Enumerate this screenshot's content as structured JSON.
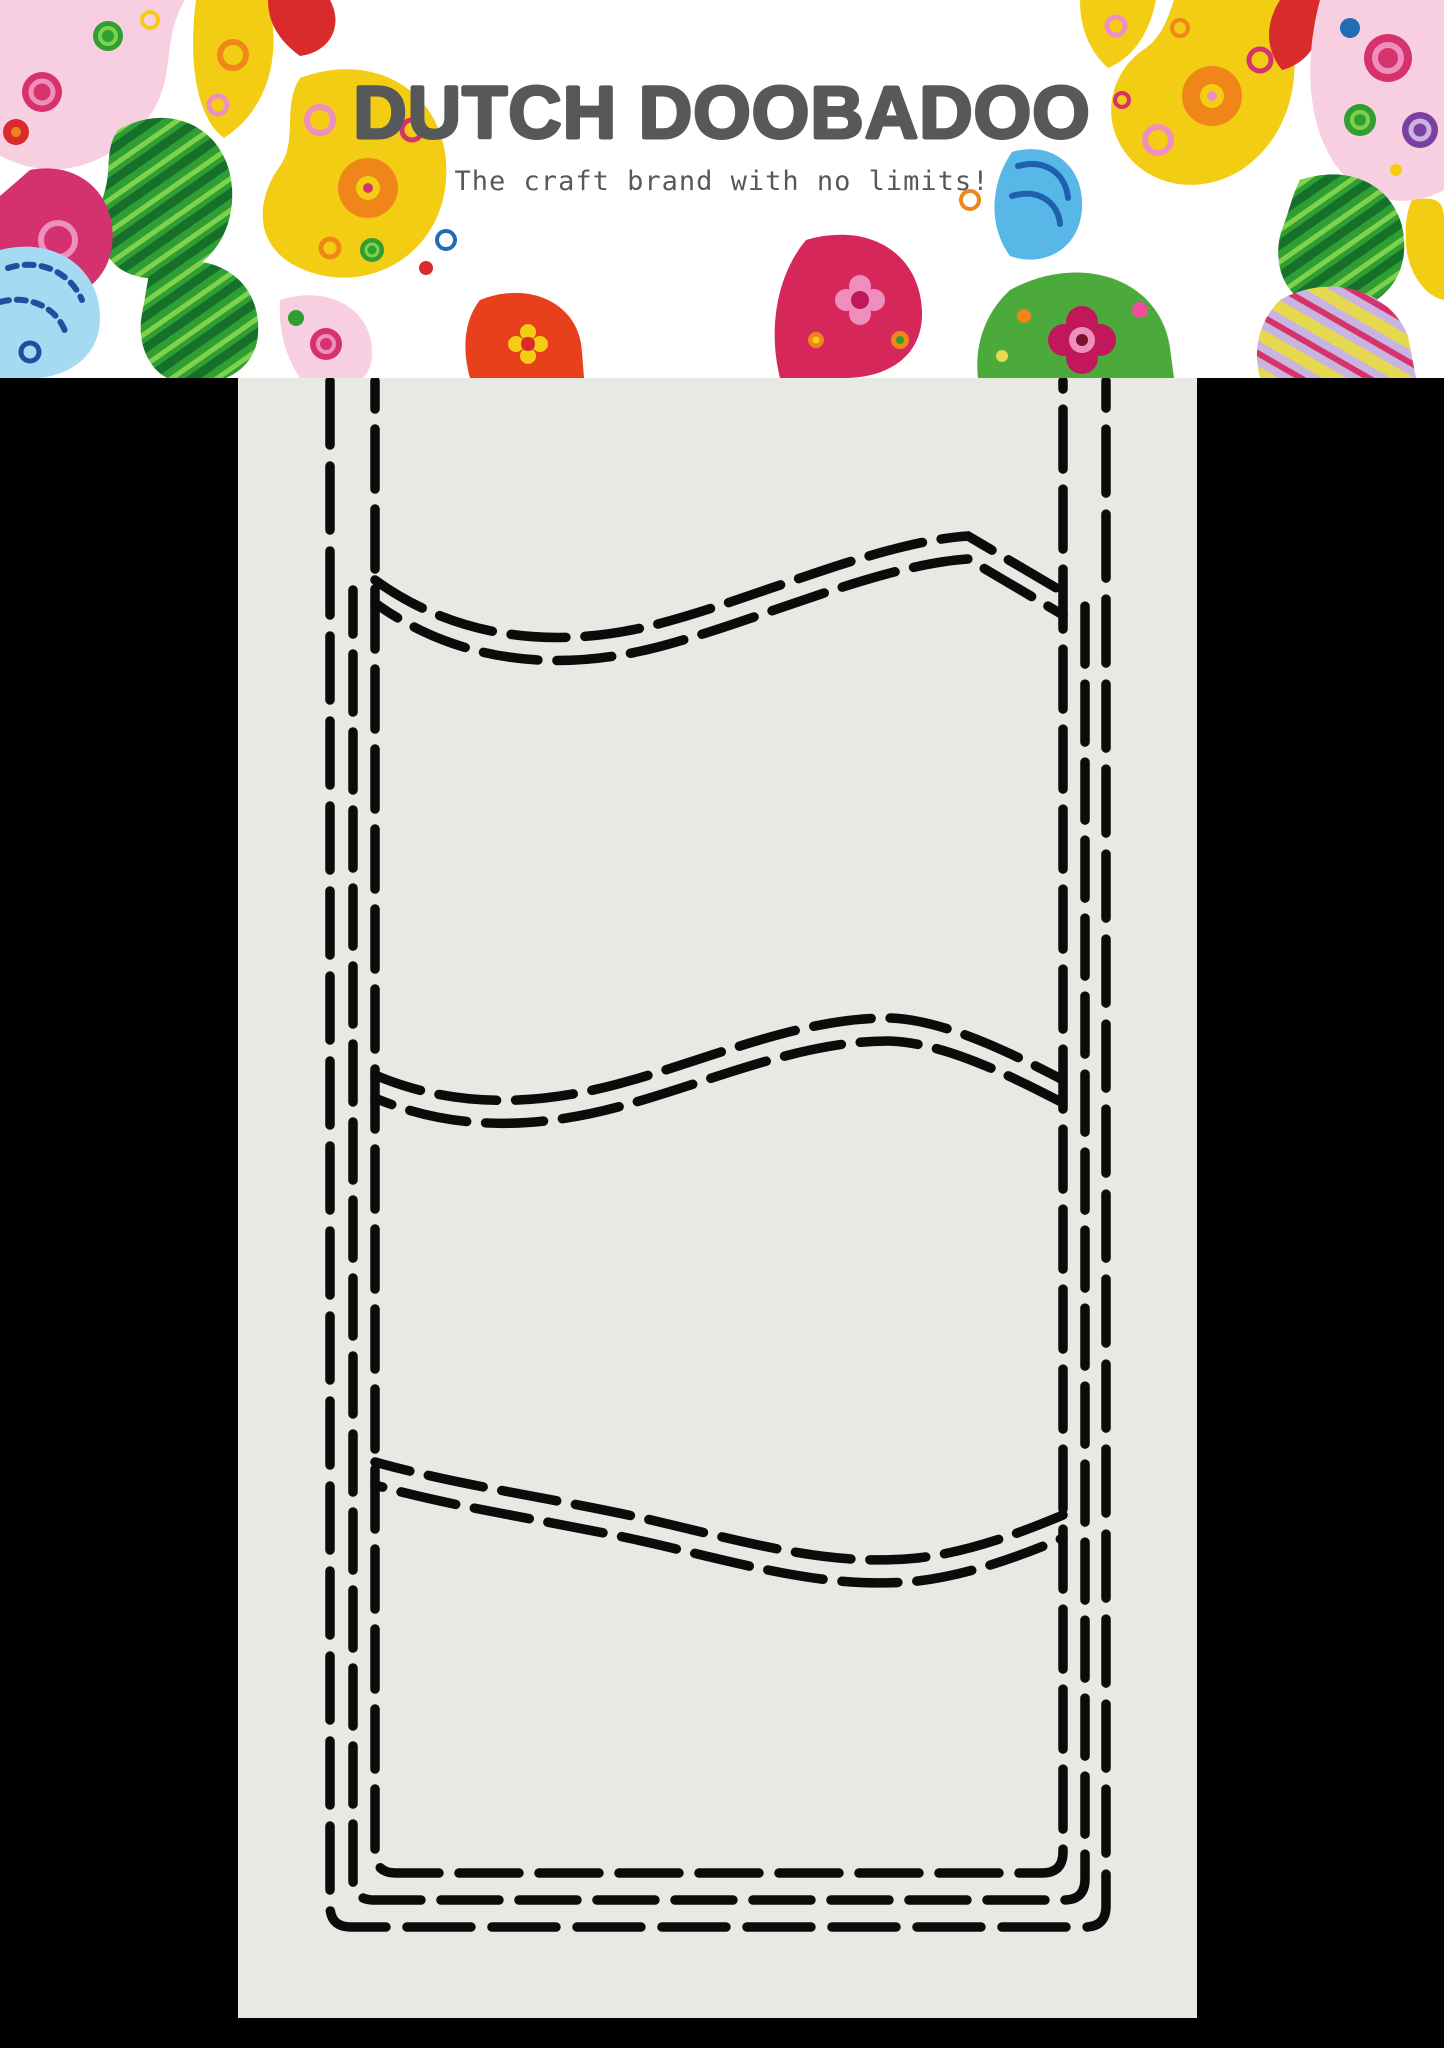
{
  "header": {
    "brand": "DUTCH DOOBADOO",
    "tagline": "The craft brand with no limits!"
  },
  "theme": {
    "page_bg": "#000000",
    "header_bg": "#ffffff",
    "text_color": "#57585a",
    "stencil_bg": "#e7e9e3",
    "line_color": "#0b0b0b"
  },
  "decoration": {
    "style": "paisley-swirl clip-art, left and right header corners",
    "palette": [
      "#f2cd13",
      "#f08519",
      "#d92b2b",
      "#d6275a",
      "#f8cfe0",
      "#ef8fc0",
      "#2f9e33",
      "#16702a",
      "#7fd24c",
      "#a6d9f2",
      "#57b8e8",
      "#1f5fae",
      "#7a3fa0",
      "#c9b3e0"
    ]
  },
  "stencil": {
    "type": "slimline card template with dashed cut lines",
    "panels": 4,
    "wave_dividers": 3,
    "border_lines": 3
  }
}
